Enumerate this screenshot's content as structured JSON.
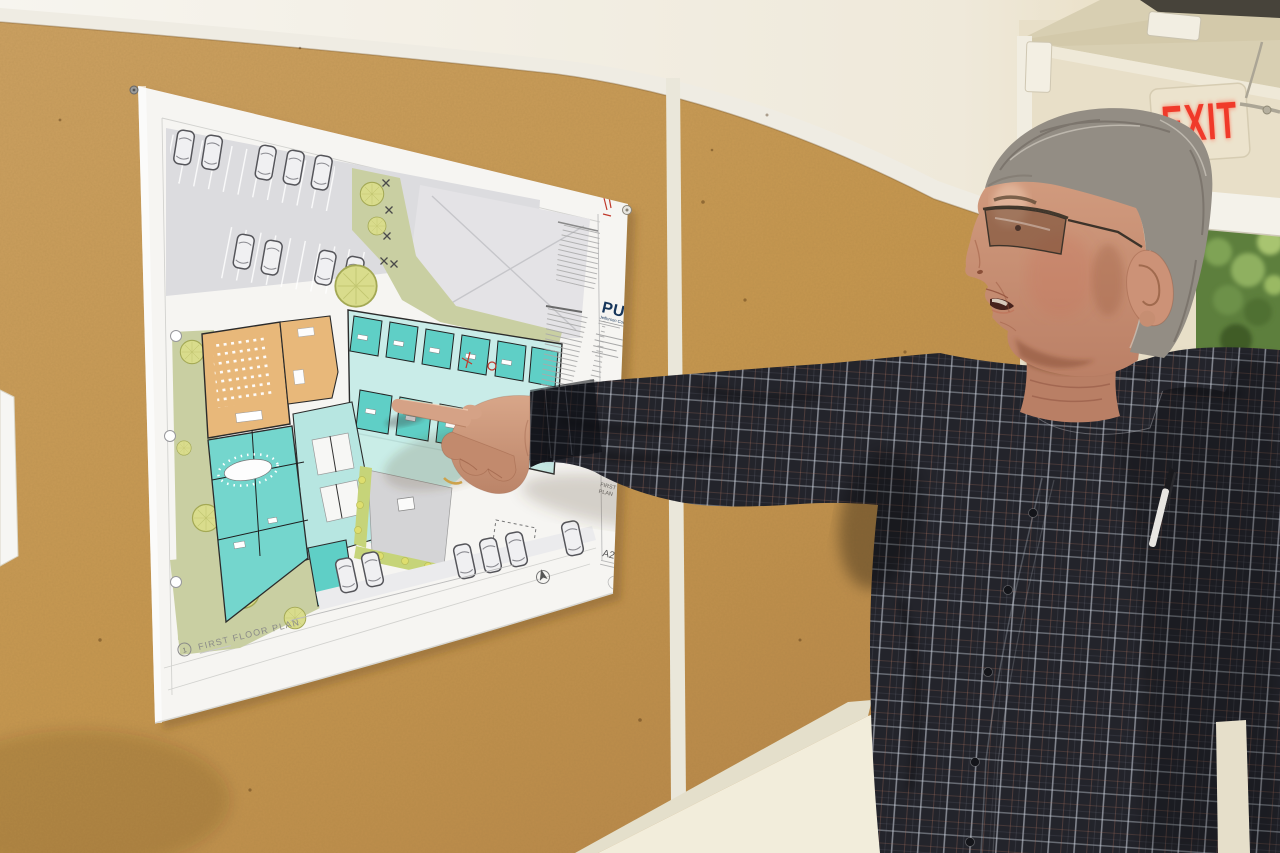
{
  "exit_sign": {
    "label": "EXIT",
    "letter_color": "#f03a2a"
  },
  "bulletin_board": {
    "cork_color": "#c89b58",
    "trim_color": "#efece3"
  },
  "drawing_sheet": {
    "drawing_title": "FIRST FLOOR PLAN",
    "detail_number": "1",
    "sheet_number": "A2.02",
    "logo": "PUD",
    "logo_subtitle": "Jefferson County",
    "title_block_sheet_title_line1": "FIRST FLOOR",
    "title_block_sheet_title_line2": "PLAN",
    "colors": {
      "office_teal": "#5fcfc6",
      "corridor_teal": "#b7e6e1",
      "meeting_orange": "#e8b87a",
      "landscape_green": "#c9cfa2",
      "tree_yellow": "#d9dc8c",
      "parking_gray": "#dcdcdf",
      "pud_navy": "#17365b"
    }
  }
}
